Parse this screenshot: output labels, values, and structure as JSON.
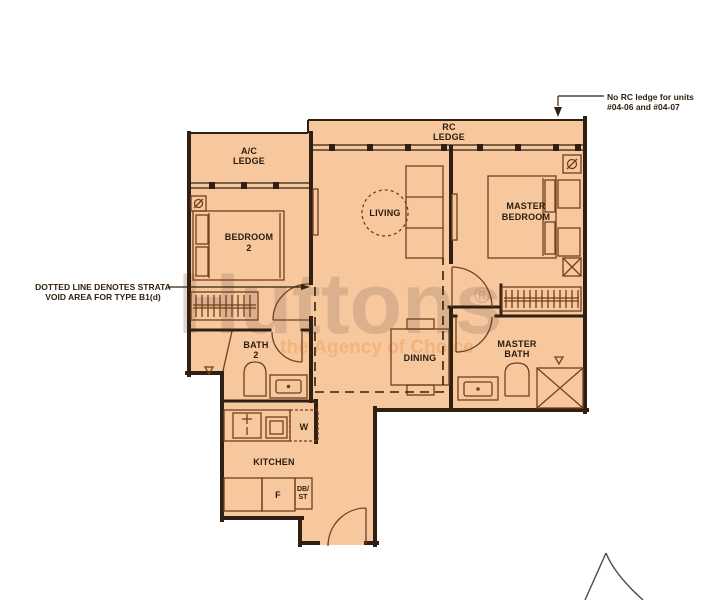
{
  "document": {
    "type": "apartment floor plan",
    "unit_type": "B1(d)"
  },
  "colors": {
    "floor_fill": "#f7c79d",
    "wall": "#2f2013",
    "fixture_line": "#70401f",
    "label_text": "#2a1c0e",
    "background": "#ffffff",
    "watermark_brand": "rgba(160,130,108,0.33)",
    "watermark_tagline": "rgba(233,148,80,0.38)"
  },
  "rooms": {
    "ac_ledge": [
      "A/C",
      "LEDGE"
    ],
    "rc_ledge": [
      "RC",
      "LEDGE"
    ],
    "bedroom2": [
      "BEDROOM",
      "2"
    ],
    "living": "LIVING",
    "master_bedroom": [
      "MASTER",
      "BEDROOM"
    ],
    "bath2": [
      "BATH",
      "2"
    ],
    "dining": "DINING",
    "master_bath": [
      "MASTER",
      "BATH"
    ],
    "kitchen": "KITCHEN"
  },
  "appliances": {
    "washer": "W",
    "fridge": "F",
    "db_st": [
      "DB/",
      "ST"
    ]
  },
  "annotations": {
    "strata": [
      "DOTTED LINE DENOTES STRATA",
      "VOID AREA FOR TYPE B1(d)"
    ],
    "rc": [
      "No RC ledge for units",
      "#04-06 and #04-07"
    ]
  },
  "watermark": {
    "brand": "Huttons",
    "registered": "®",
    "tagline": "the Agency of Choice"
  }
}
